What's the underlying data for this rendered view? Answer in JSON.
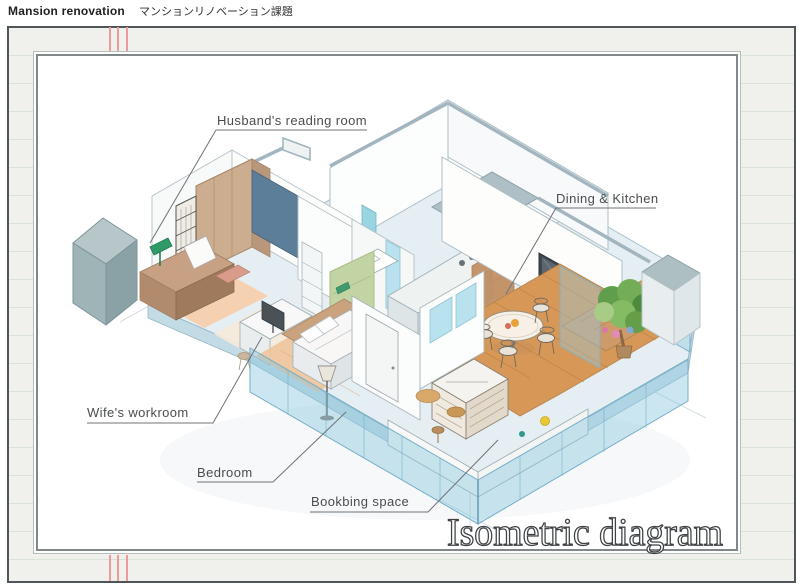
{
  "header": {
    "title_en": "Mansion renovation",
    "title_ja": "マンションリノベーション課題"
  },
  "canvas": {
    "title": "Isometric diagram"
  },
  "room_labels": {
    "reading": "Husband's reading room",
    "dining": "Dining & Kitchen",
    "workroom": "Wife's workroom",
    "bedroom": "Bedroom",
    "bookbinding": "Bookbing space"
  },
  "drawing": {
    "type": "isometric cutaway floor plan, hand-drawn watercolor style",
    "rooms": [
      "Husband's reading room",
      "Wife's workroom",
      "Bedroom",
      "Bookbing space",
      "Dining & Kitchen",
      "Balcony garden"
    ]
  },
  "palette": {
    "paper": "#f0f1ec",
    "paper_line": "#d9e3da",
    "page_border": "#50555a",
    "panel_border": "#80888a",
    "binding_mark": "#ef9a9a",
    "label_text": "#4a4d4e",
    "title_outline": "#3f4345",
    "slab_blue": "#e4eef3",
    "glass_blue": "#a8d8ea",
    "wood": "#d79757",
    "wood_light": "#eec49a",
    "furniture_tan": "#cdad90",
    "accent_wall_green": "#c3d4a4",
    "accent_wall_blue": "#5d7e99",
    "plant_green": "#5f9e4a",
    "shaft_gray": "#aebfc4",
    "beam_gray": "#9fb3bc"
  }
}
